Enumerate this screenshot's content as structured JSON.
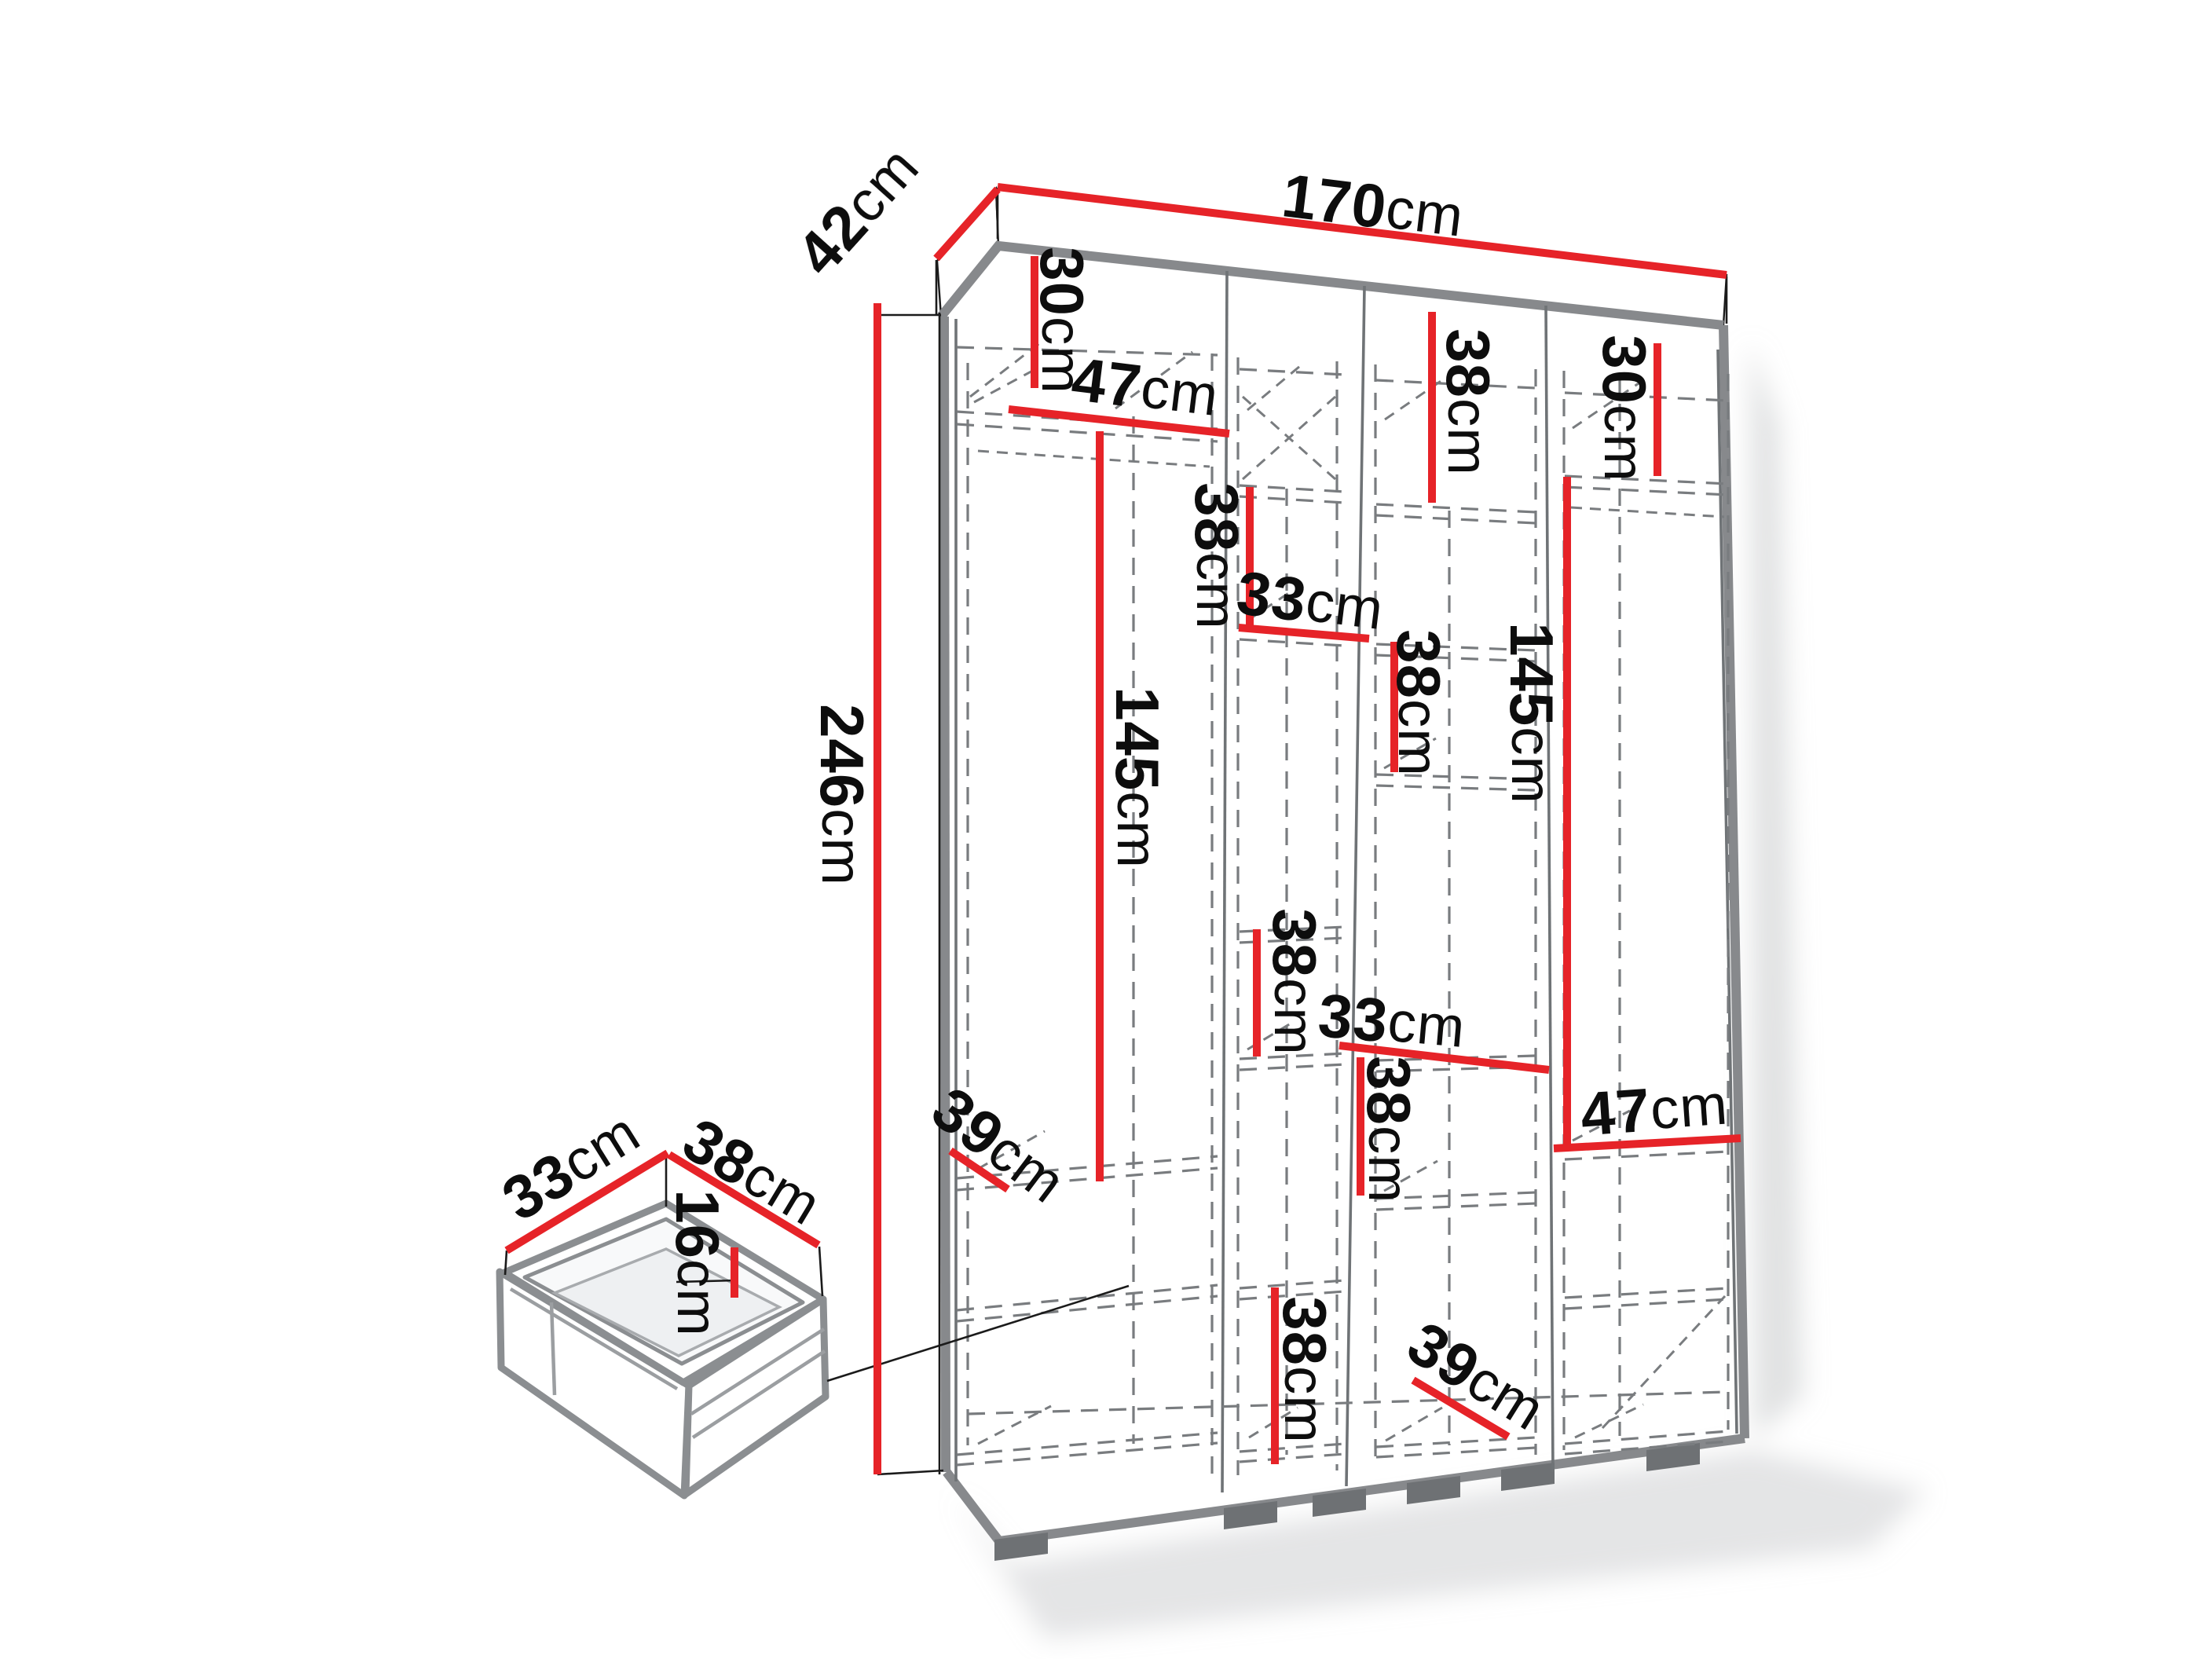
{
  "figure": {
    "kind": "wardrobe interior dimension diagram",
    "unit": "cm"
  },
  "colors": {
    "dimension_red": "#e62328",
    "cabinet_gray": "#87898c",
    "dash_gray": "#797c7f",
    "text_black": "#0d0d0d",
    "shadow_gray": "#c4c6c8"
  },
  "labels": {
    "dim_42": {
      "num": "42",
      "unit": "cm",
      "measures": "overall depth, top-left edge"
    },
    "dim_170": {
      "num": "170",
      "unit": "cm",
      "measures": "overall width, top edge"
    },
    "dim_246": {
      "num": "246",
      "unit": "cm",
      "measures": "overall height, left side"
    },
    "c1_30": {
      "num": "30",
      "unit": "cm",
      "measures": "column 1 top section height"
    },
    "c1_47": {
      "num": "47",
      "unit": "cm",
      "measures": "column 1 width"
    },
    "c1_145": {
      "num": "145",
      "unit": "cm",
      "measures": "column 1 hanging section height"
    },
    "c1_39": {
      "num": "39",
      "unit": "cm",
      "measures": "column 1 shelf depth"
    },
    "c2_38_upper": {
      "num": "38",
      "unit": "cm",
      "measures": "column 2 upper section height"
    },
    "c2_33": {
      "num": "33",
      "unit": "cm",
      "measures": "column 2 width"
    },
    "c2_38_middle": {
      "num": "38",
      "unit": "cm",
      "measures": "column 2 middle section height"
    },
    "c2_38_lower": {
      "num": "38",
      "unit": "cm",
      "measures": "column 2 lower section height"
    },
    "c3_38_top": {
      "num": "38",
      "unit": "cm",
      "measures": "column 3 top section height"
    },
    "c3_38_upper": {
      "num": "38",
      "unit": "cm",
      "measures": "column 3 upper section height"
    },
    "c3_33": {
      "num": "33",
      "unit": "cm",
      "measures": "column 3 width"
    },
    "c3_38_lower": {
      "num": "38",
      "unit": "cm",
      "measures": "column 3 lower section height"
    },
    "c3_39": {
      "num": "39",
      "unit": "cm",
      "measures": "column 3 shelf depth"
    },
    "c4_30": {
      "num": "30",
      "unit": "cm",
      "measures": "column 4 top section height"
    },
    "c4_145": {
      "num": "145",
      "unit": "cm",
      "measures": "column 4 hanging section height"
    },
    "c4_47": {
      "num": "47",
      "unit": "cm",
      "measures": "column 4 width"
    },
    "drawer_33": {
      "num": "33",
      "unit": "cm",
      "measures": "drawer width"
    },
    "drawer_38": {
      "num": "38",
      "unit": "cm",
      "measures": "drawer depth"
    },
    "drawer_16": {
      "num": "16",
      "unit": "cm",
      "measures": "drawer height"
    }
  }
}
